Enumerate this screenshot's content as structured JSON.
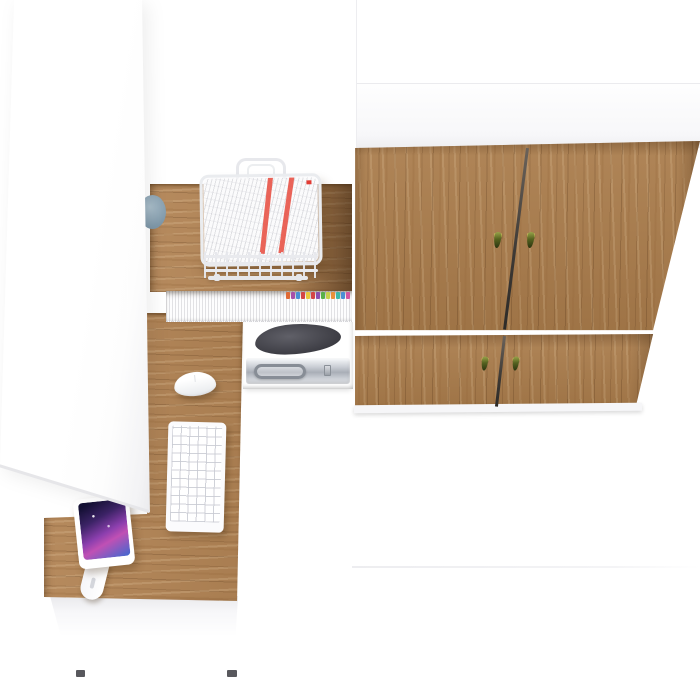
{
  "meta": {
    "description": "Top-down 3D render of a home-office furniture set: white wardrobe, oak corner desk with hutch, and oak two-door tall cabinet",
    "view": "top-down render",
    "background": "#ffffff"
  },
  "palette": {
    "desk_wood": "#b28455",
    "desk_wood_shadow": "#7a5226",
    "cabinet_door_wood": "#aa7c4b",
    "door_divider": "#3c3834",
    "handle_brass": "#c9b455",
    "handle_tassel_green": "#46511f",
    "wire_tray": "#eaecef",
    "paper_white": "#fbfbfc",
    "document_stripe_red": "#e8574b",
    "cable_grommet_blue": "#8ba4b4",
    "monitor_screen": [
      "#141034",
      "#8c3fae",
      "#3f68d0"
    ],
    "metal_case": "#b6bbc3",
    "printer_bag_dark": "#3a3a41",
    "drawer_foot_dark": "#58585d"
  },
  "scene": {
    "items": [
      {
        "name": "wardrobe-left",
        "label": "White tall wardrobe cabinet"
      },
      {
        "name": "desk-hutch-top",
        "label": "Oak desk hutch top surface"
      },
      {
        "name": "document-tray",
        "label": "White wire document tray holding papers with red stripes"
      },
      {
        "name": "file-shelf",
        "label": "Hutch shelf filled with white files and colored index tabs"
      },
      {
        "name": "printer-shelf",
        "label": "Hutch shelf with dark bag"
      },
      {
        "name": "case-shelf",
        "label": "Hutch shelf with aluminum case"
      },
      {
        "name": "desk-return",
        "label": "Oak desk return work surface"
      },
      {
        "name": "keyboard",
        "label": "White keyboard"
      },
      {
        "name": "mouse",
        "label": "White mouse"
      },
      {
        "name": "monitor",
        "label": "Display on white articulated arm"
      },
      {
        "name": "drawer-unit",
        "label": "White under-desk drawer unit"
      },
      {
        "name": "tall-cabinet-right",
        "label": "Oak tall cabinet with two door rows and tassel pulls"
      },
      {
        "name": "cable-grommet",
        "label": "Blue-grey cable grommet"
      }
    ],
    "file_tabs": {
      "colors": [
        "#e06a35",
        "#a84fa8",
        "#4a8fd4",
        "#d44545",
        "#e8c83c",
        "#d44545",
        "#8a4fb0",
        "#58b048",
        "#c6d04a",
        "#e8903a",
        "#3cb8a8",
        "#4a8fd4",
        "#d455a0"
      ]
    },
    "cabinet": {
      "door_rows": 2,
      "handle_count": 4
    },
    "tray_documents": {
      "red_stripe_count": 2
    }
  }
}
